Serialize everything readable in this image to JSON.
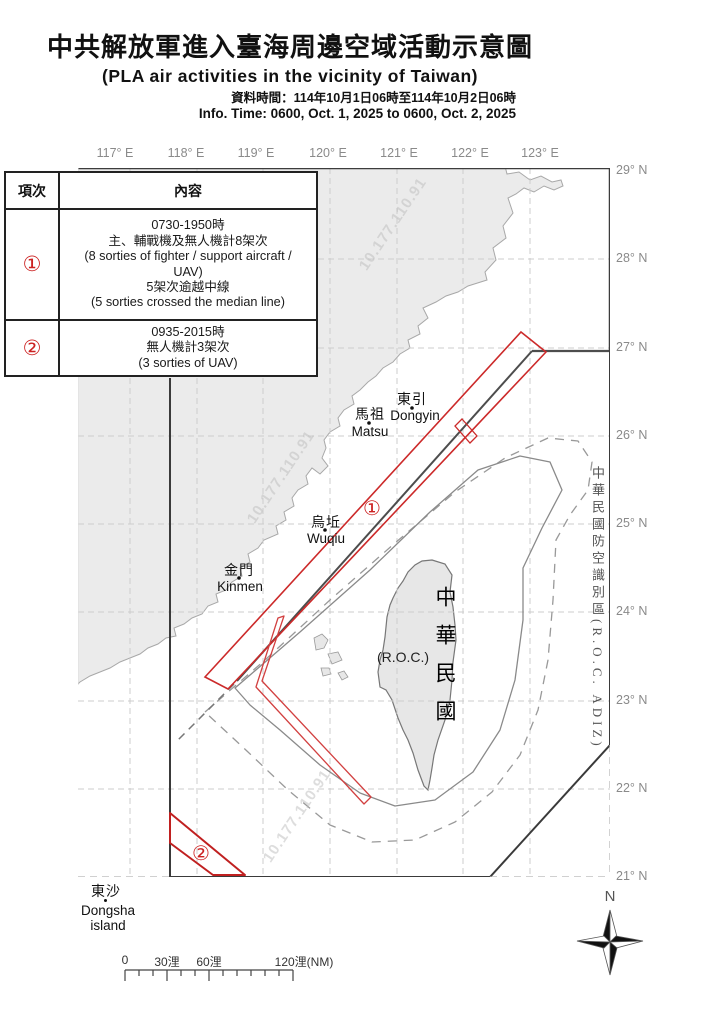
{
  "header": {
    "title": "中共解放軍進入臺海周邊空域活動示意圖",
    "subtitle": "(PLA air activities in the vicinity of Taiwan)",
    "info_time_zh": "資料時間：114年10月1日06時至114年10月2日06時",
    "info_time_en": "Info. Time: 0600, Oct. 1, 2025 to 0600, Oct. 2, 2025"
  },
  "table": {
    "col_headers": [
      "項次",
      "內容"
    ],
    "rows": [
      {
        "num": "①",
        "content": "0730-1950時\n主、輔戰機及無人機計8架次\n(8 sorties of fighter / support aircraft /\nUAV)\n5架次逾越中線\n(5 sorties crossed the median line)"
      },
      {
        "num": "②",
        "content": "0935-2015時\n無人機計3架次\n(3 sorties of UAV)"
      }
    ]
  },
  "map": {
    "lon_labels": [
      "117° E",
      "118° E",
      "119° E",
      "120° E",
      "121° E",
      "122° E",
      "123° E"
    ],
    "lat_labels": [
      "29° N",
      "28° N",
      "27° N",
      "26° N",
      "25° N",
      "24° N",
      "23° N",
      "22° N",
      "21° N"
    ],
    "places": {
      "dongyin": {
        "zh": "東引",
        "en": "Dongyin"
      },
      "matsu": {
        "zh": "馬祖",
        "en": "Matsu"
      },
      "wuqiu": {
        "zh": "烏坵",
        "en": "Wuqiu"
      },
      "kinmen": {
        "zh": "金門",
        "en": "Kinmen"
      },
      "dongsha": {
        "zh": "東沙",
        "en": "Dongsha",
        "en2": "island"
      }
    },
    "roc_label_vertical": "中華民國",
    "roc_label_paren": "(R.O.C.)",
    "adiz_label": "中華民國防空識別區(R.O.C. ADIZ)",
    "route_markers": [
      "①",
      "②"
    ],
    "watermark": "10.177.110.91"
  },
  "scalebar": {
    "labels": [
      "0",
      "30浬",
      "60浬",
      "120浬(NM)"
    ]
  },
  "compass": {
    "north_label": "N"
  },
  "colors": {
    "route_red": "#cc2222",
    "land_fill": "#ebebeb",
    "taiwan_outline": "#777777",
    "median_line": "#4d4d4d",
    "adiz_line": "#3a3a3a",
    "grid_line": "#cccccc",
    "coord_label_gray": "#8a8a8a"
  }
}
